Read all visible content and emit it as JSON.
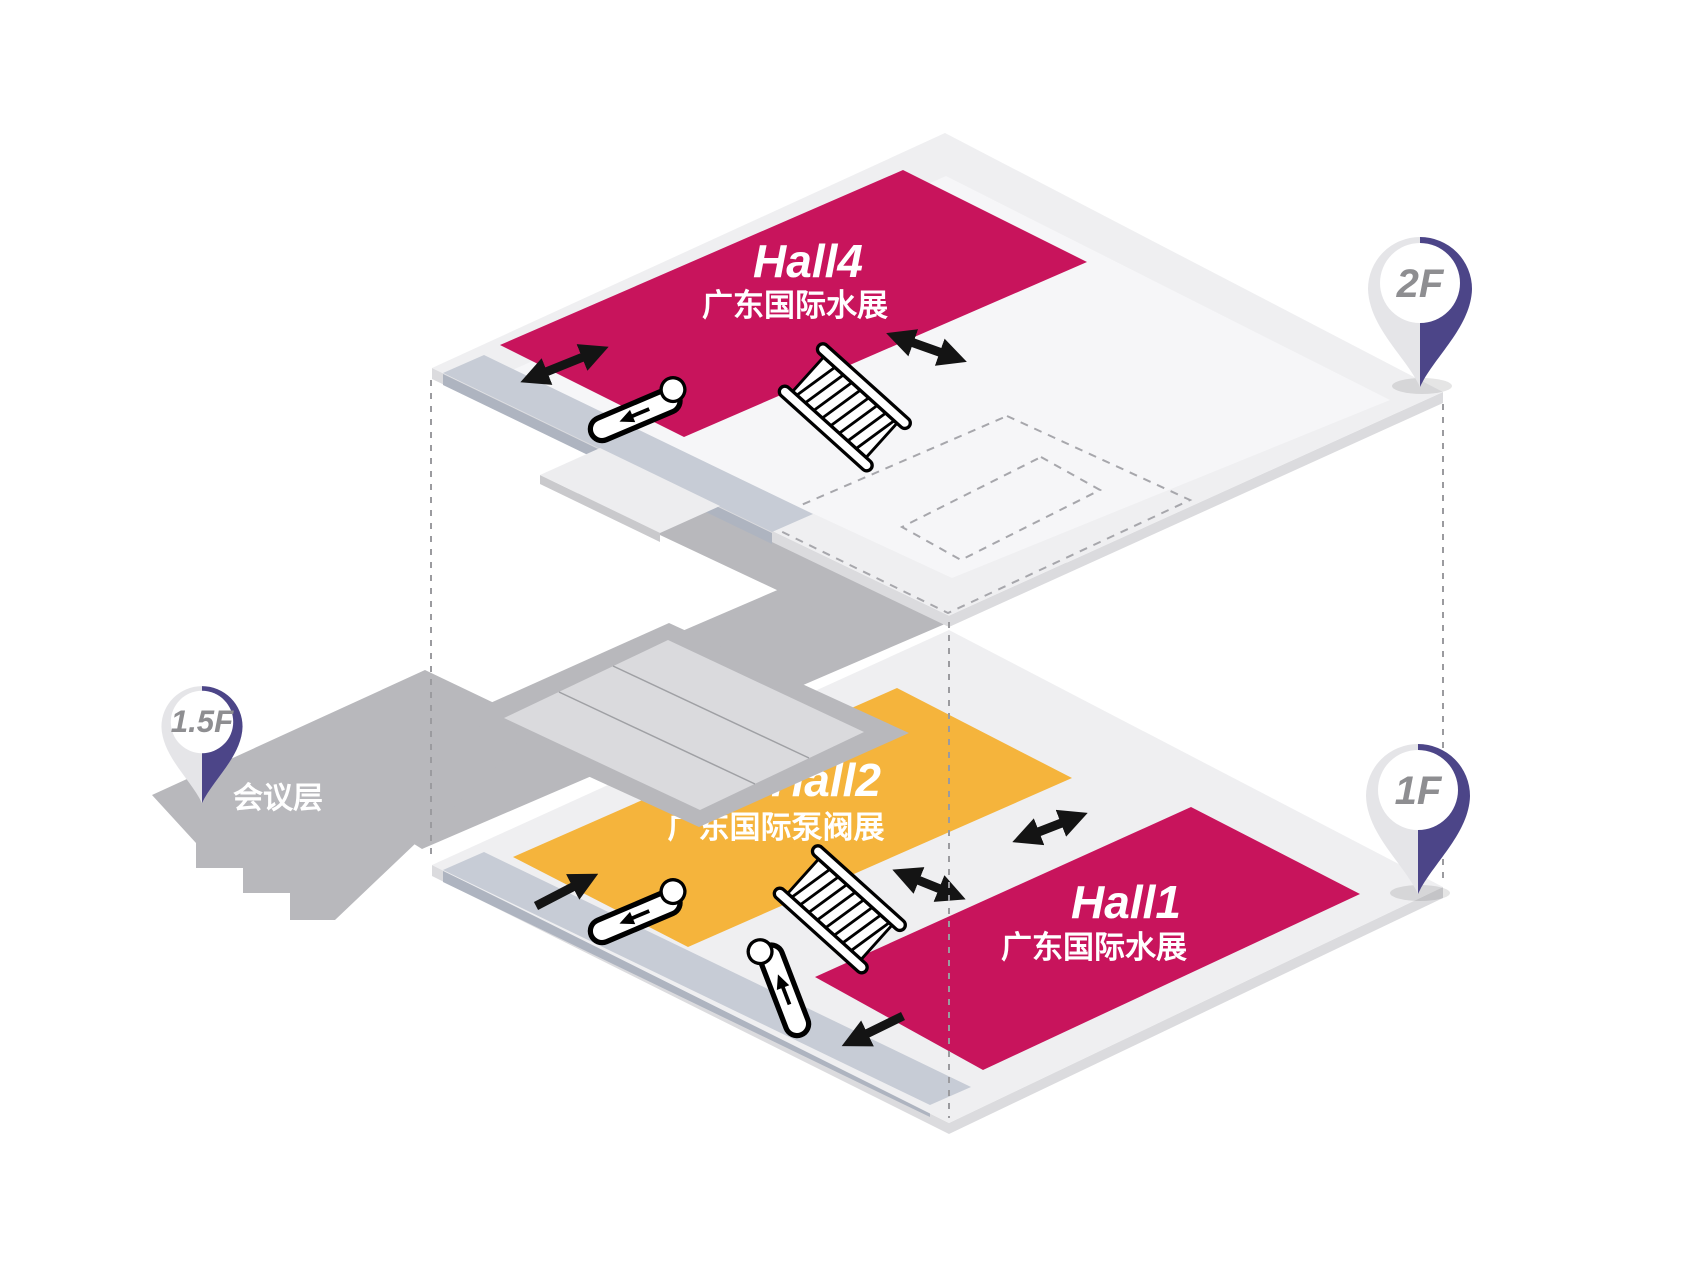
{
  "colors": {
    "hall_red": "#C8145C",
    "hall_yellow": "#F5B43C",
    "pin_purple": "#4C4588",
    "pin_gray": "#E5E5E8",
    "pin_text": "#8E8E91",
    "floor": "#EFEFF1",
    "floor_edge": "#DBDBDE",
    "floor_inner": "#F6F6F8",
    "walkway_strip": "#C7CCD6",
    "walkway_strip_edge": "#AEB4C0",
    "bridge_gray": "#B8B8BC",
    "stairs_panel": "#DADADD",
    "arrow": "#141414",
    "label_white": "#FFFFFF",
    "dashed_line": "#9B9B9F"
  },
  "floor2": {
    "pin_label": "2F",
    "hall4": {
      "name": "Hall4",
      "subtitle": "广东国际水展"
    }
  },
  "floor1": {
    "pin_label": "1F",
    "hall2": {
      "name": "Hall2",
      "subtitle": "广东国际泵阀展"
    },
    "hall1": {
      "name": "Hall1",
      "subtitle": "广东国际水展"
    }
  },
  "floor15": {
    "pin_label": "1.5F",
    "area_label": "会议层"
  },
  "icons": {
    "escalator": "escalator",
    "moving_walkway": "moving-walkway",
    "location_pin": "location-pin",
    "connection_arrow": "double-arrow"
  }
}
